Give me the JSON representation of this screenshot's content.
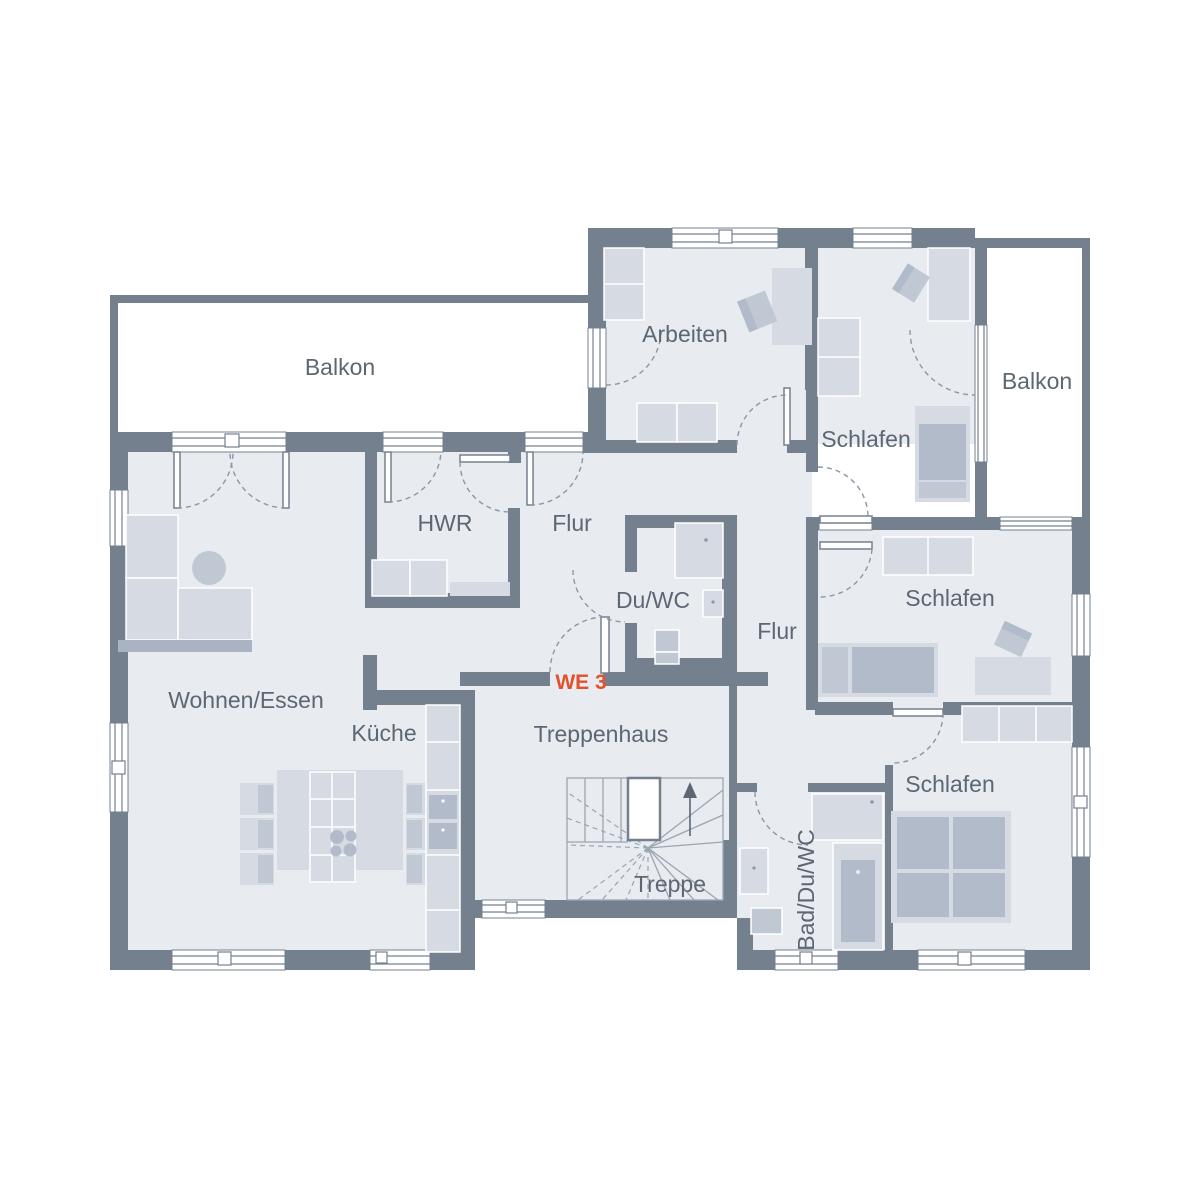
{
  "plan": {
    "unit_label": "WE 3",
    "rooms": {
      "balkon_left": "Balkon",
      "arbeiten": "Arbeiten",
      "schlafen_top": "Schlafen",
      "balkon_right": "Balkon",
      "hwr": "HWR",
      "flur_upper": "Flur",
      "du_wc": "Du/WC",
      "flur_lower": "Flur",
      "schlafen_middle": "Schlafen",
      "wohnen_essen": "Wohnen/Essen",
      "kueche": "Küche",
      "treppenhaus": "Treppenhaus",
      "treppe": "Treppe",
      "bad_du_wc": "Bad/Du/WC",
      "schlafen_bottom": "Schlafen"
    },
    "colors": {
      "wall": "#75808f",
      "room_fill": "#e8ebf0",
      "balcony_fill": "#ffffff",
      "furniture_light": "#d6dbe3",
      "furniture_medium": "#c0c8d3",
      "furniture_dark": "#b2bbc9",
      "dashed_line": "#8b97a6",
      "label_text": "#5c6773",
      "accent_red": "#e2512e"
    }
  }
}
